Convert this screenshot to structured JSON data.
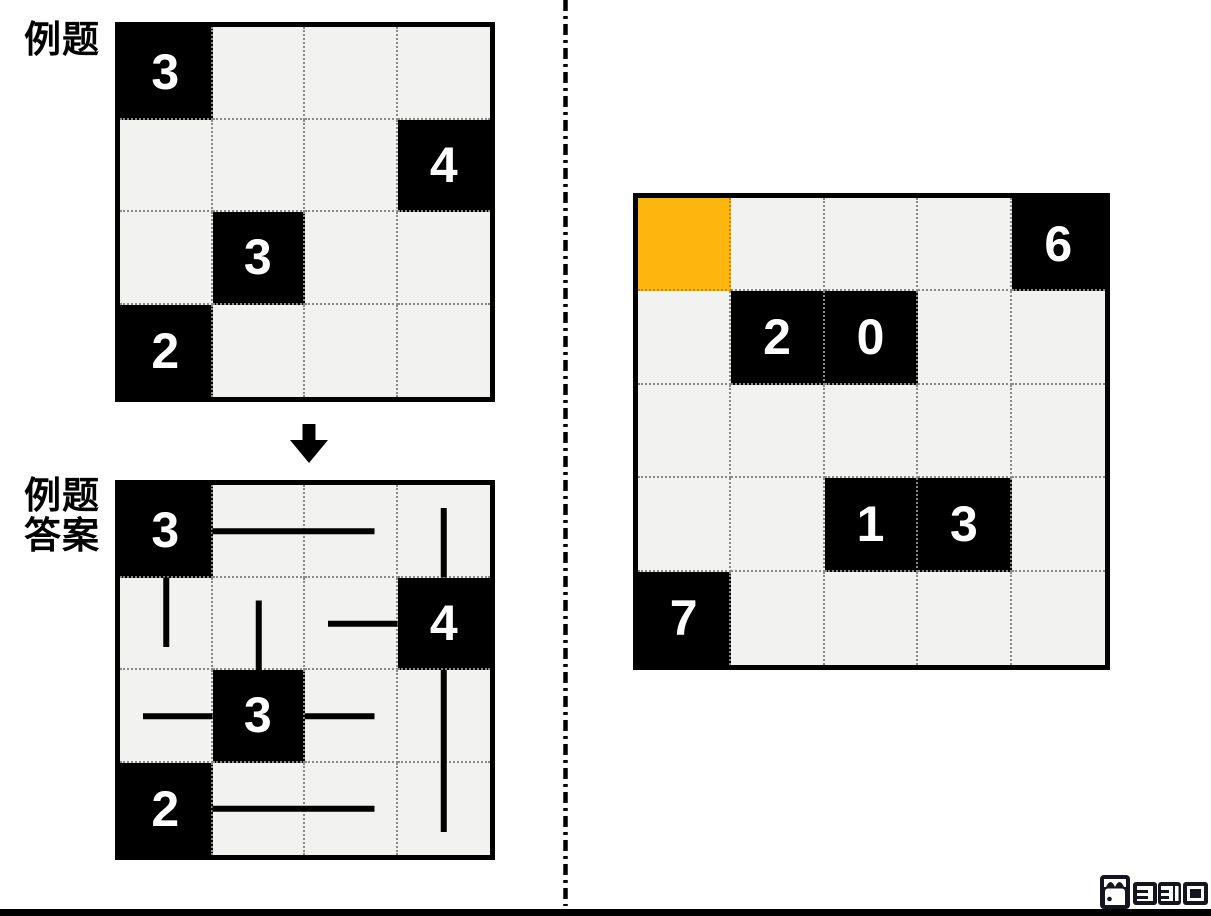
{
  "labels": {
    "example_title": "例题",
    "answer_title_line1": "例题",
    "answer_title_line2": "答案"
  },
  "example_grid": {
    "rows": 4,
    "cols": 4,
    "clues": [
      {
        "row": 0,
        "col": 0,
        "value": "3"
      },
      {
        "row": 1,
        "col": 3,
        "value": "4"
      },
      {
        "row": 2,
        "col": 1,
        "value": "3"
      },
      {
        "row": 3,
        "col": 0,
        "value": "2"
      }
    ]
  },
  "answer_grid": {
    "rows": 4,
    "cols": 4,
    "clues": [
      {
        "row": 0,
        "col": 0,
        "value": "3"
      },
      {
        "row": 1,
        "col": 3,
        "value": "4"
      },
      {
        "row": 2,
        "col": 1,
        "value": "3"
      },
      {
        "row": 3,
        "col": 0,
        "value": "2"
      }
    ],
    "arms": [
      {
        "row": 0,
        "col": 0,
        "dir": "right",
        "cells": 2
      },
      {
        "row": 0,
        "col": 0,
        "dir": "down",
        "cells": 1
      },
      {
        "row": 1,
        "col": 3,
        "dir": "up",
        "cells": 1
      },
      {
        "row": 1,
        "col": 3,
        "dir": "left",
        "cells": 1
      },
      {
        "row": 1,
        "col": 3,
        "dir": "down",
        "cells": 2
      },
      {
        "row": 2,
        "col": 1,
        "dir": "up",
        "cells": 1
      },
      {
        "row": 2,
        "col": 1,
        "dir": "left",
        "cells": 1
      },
      {
        "row": 2,
        "col": 1,
        "dir": "right",
        "cells": 1
      },
      {
        "row": 3,
        "col": 0,
        "dir": "right",
        "cells": 2
      }
    ]
  },
  "puzzle_grid": {
    "rows": 5,
    "cols": 5,
    "clues": [
      {
        "row": 0,
        "col": 4,
        "value": "6"
      },
      {
        "row": 1,
        "col": 1,
        "value": "2"
      },
      {
        "row": 1,
        "col": 2,
        "value": "0"
      },
      {
        "row": 3,
        "col": 2,
        "value": "1"
      },
      {
        "row": 3,
        "col": 3,
        "value": "3"
      },
      {
        "row": 4,
        "col": 0,
        "value": "7"
      }
    ],
    "highlight": {
      "row": 0,
      "col": 0
    }
  },
  "colors": {
    "grid_border": "#000000",
    "cell_bg": "#f2f2f0",
    "dotted_line": "#8a8a8a",
    "black_cell": "#000000",
    "clue_text": "#ffffff",
    "highlight": "#fdb60d",
    "answer_line": "#000000",
    "divider": "#000000",
    "footer_bar": "#000000",
    "logo": "#15151f"
  },
  "footer": {
    "icons": [
      "door-logo-icon",
      "bracket-icon-1",
      "bracket-icon-2",
      "square-icon"
    ]
  }
}
